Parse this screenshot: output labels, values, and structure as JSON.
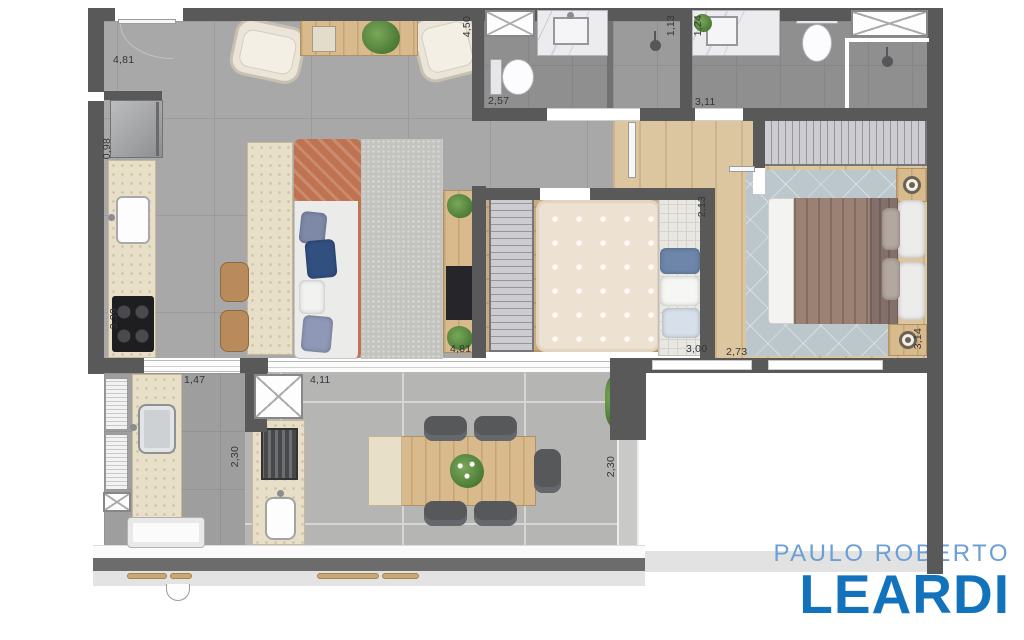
{
  "logo": {
    "line1": "PAULO ROBERTO",
    "line2": "LEARDI"
  },
  "dimensions": {
    "living_top": "4,81",
    "living_left_upper": "0,98",
    "kitchen_left": "3,39",
    "living_right": "4,50",
    "bath1_width": "2,57",
    "shower1_width": "1,13",
    "bath2_left": "1,24",
    "bath2_width": "3,11",
    "bedroom2_depth": "2,13",
    "living_bottom": "4,81",
    "bedroom2_width": "3,00",
    "master_width": "2,73",
    "master_depth": "3,14",
    "laundry_width": "1,47",
    "laundry_depth": "2,30",
    "terrace_width": "4,11",
    "terrace_depth": "2,30"
  },
  "colors": {
    "wall": "#595959",
    "logo1": "#1273bc",
    "logo2": "#6b9fd6"
  }
}
